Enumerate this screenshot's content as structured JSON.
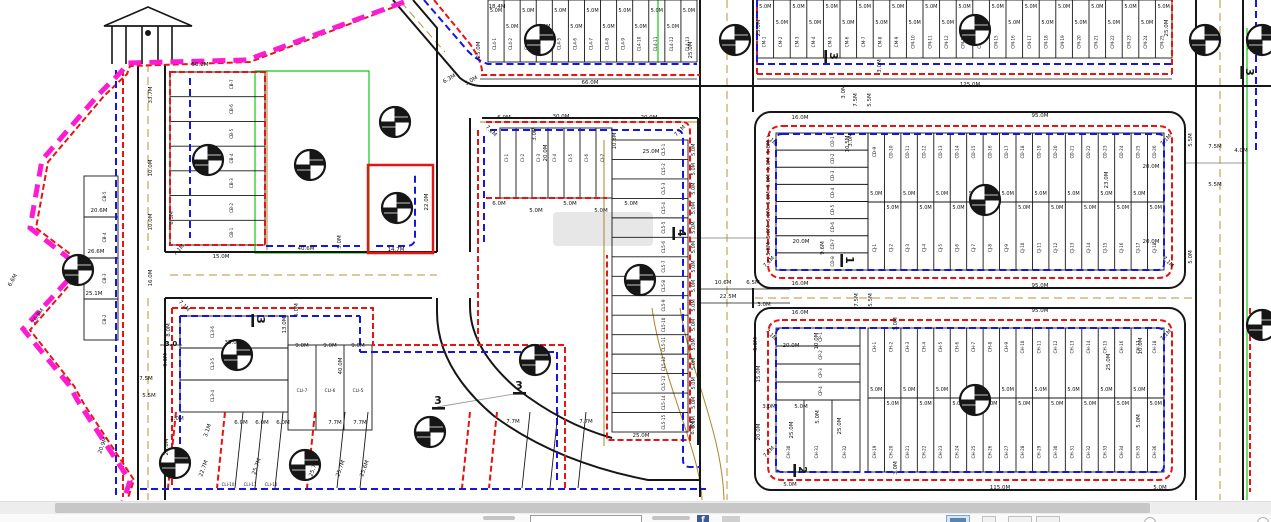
{
  "map": {
    "colors": {
      "red": "#e81313",
      "blue": "#1616e0",
      "magenta": "#ff1bd3",
      "green": "#14c814",
      "tan": "#a8862c",
      "tan_dash": "#b5913d",
      "black": "#161616",
      "gray": "#9a9a9a",
      "label": "#111111",
      "watermark": "rgba(120,120,120,0.18)"
    },
    "roads_black": [
      "M393,0 L460,78 Q470,86 482,86 H1271",
      "M413,0 L437,28 V252",
      "M437,298 V312 Q437,368 494,416 Q556,462 648,480 H700",
      "M470,118 V252",
      "M470,298 V306 Q470,348 516,388 Q562,424 612,438",
      "M482,118 H698",
      "M165,252 H437",
      "M165,298 H432",
      "M138,64 V500",
      "M165,64 V252",
      "M165,298 V500",
      "M700,0 V497",
      "M753,0 V112",
      "M753,288 V308",
      "M1196,0 V500",
      "M1243,0 V500",
      "M698,118 V445"
    ],
    "roads_thin": [
      "M480,79 H697",
      "M757,79 H1172",
      "M700,289 H790",
      "M700,303 H790",
      "M160,345 H182"
    ],
    "road_rects": [
      {
        "x": 755,
        "y": 112,
        "w": 430,
        "h": 176,
        "rx": 16
      },
      {
        "x": 755,
        "y": 308,
        "w": 430,
        "h": 182,
        "rx": 16
      }
    ],
    "gate": {
      "paths": [
        "M104,26 H192",
        "M104,26 L148,7 L192,26 Z",
        "M112,26 V64",
        "M126,26 V64",
        "M142,26 V64",
        "M158,26 V64",
        "M172,26 V64"
      ],
      "dot": [
        148,
        33,
        3
      ]
    },
    "tan_solid": [
      "M267,70 V250",
      "M604,140 V446",
      "M480,122 H698",
      "M652,308 C662,380 700,450 702,500",
      "M680,308 C690,372 722,432 724,500"
    ],
    "tan_dashed": [
      "M148,64 V250",
      "M148,298 V500",
      "M727,0 V500",
      "M1220,0 V500",
      "M170,275 H437",
      "M755,298 H1196",
      "M401,2 L445,52"
    ],
    "green_lines": [
      "M255,71 H369 V253 H255 Z",
      "M1247,28 V500",
      "M1247,50 L1262,28",
      "M658,0 V62"
    ],
    "gray_lines": [
      "M690,238 H770",
      "M1185,163 H1246",
      "M437,407 L520,393"
    ],
    "red_dashed": [
      "M402,4 L250,62 L130,66 L127,74 L104,96 L48,162 L36,228 L86,266 L30,330 L74,386 L84,404 L134,480 L128,498",
      "M123,70 V497",
      "M170,72 H265 V245 H170 Z",
      "M434,0 L470,44 Q480,58 482,70 V75 H700",
      "M757,74 V0 M757,74 H1172 M1172,74 V0",
      "M782,126 H1158 Q1172,126 1172,140 V264 Q1172,278 1158,278 H782 Q768,278 768,264 V140 Q768,126 782,126 Z",
      "M782,320 H1158 Q1172,320 1172,334 V466 Q1172,480 1158,480 H782 Q768,480 768,466 V334 Q768,320 782,320 Z",
      "M486,122 H682 Q690,122 690,132 V440 H607 V255",
      "M478,130 V340",
      "M486,198 H607",
      "M172,308 H373 V345 H565 V488",
      "M172,308 V488",
      "M176,412 L168,488 M225,412 L217,488 M315,412 L307,488 M470,412 L462,488 M497,412 L489,488",
      "M1250,308 V492"
    ],
    "red_solid": [
      "M368,165 H433 V253 H368 Z"
    ],
    "blue_dashed": [
      "M116,70 V495",
      "M190,78 V238",
      "M266,246 H360 M376,246 H406 Q415,246 415,238 V175",
      "M424,0 L467,50 Q476,60 488,64 H697",
      "M757,62 V0 M757,64 H1172",
      "M782,134 H1158 Q1164,134 1164,140 V264 Q1164,270 1158,270 H782 Q776,270 776,264 V140 Q776,134 782,134 Z",
      "M782,328 H1158 Q1164,328 1164,334 V466 Q1164,472 1158,472 H782 Q776,472 776,466 V334 Q776,328 782,328 Z",
      "M490,130 H676 Q683,130 683,138 V460 Q683,467 690,467 H700",
      "M484,136 V246",
      "M180,316 V480 M180,316 H360 M360,316 V352 M360,352 H557 M557,352 V480",
      "M140,489 H706",
      "M1256,0 V152"
    ],
    "magenta_path": "M404,2 L247,60 L128,63 L121,72 L99,94 L42,160 L30,228 L80,267 L23,329 L69,385 L79,403 L130,481 L123,502",
    "slant_black": [
      243,
      263,
      283,
      345,
      368,
      530,
      558,
      586
    ],
    "slant_top_y": 412,
    "slant_bot_y": 488,
    "slant_dx": -8,
    "lot_blocks": [
      {
        "id": "cl4",
        "type": "cols",
        "x": 488,
        "y": 0,
        "w": 209,
        "h": 62,
        "n": 13,
        "prefix": "CL4-",
        "start": 1,
        "step": 1,
        "label_y": 44,
        "dims": "5.0M",
        "dims_y": [
          12,
          28
        ]
      },
      {
        "id": "cm",
        "type": "cols",
        "x": 757,
        "y": 0,
        "w": 415,
        "h": 58,
        "n": 25,
        "prefix": "CM-",
        "start": 1,
        "step": 1,
        "label_y": 42,
        "dims": "5.0M",
        "dims_y": [
          8,
          24
        ]
      },
      {
        "id": "cb-a",
        "type": "rows",
        "x": 170,
        "y": 72,
        "w": 95,
        "h": 173,
        "n": 7,
        "prefix": "CB-",
        "start": 7,
        "step": -1,
        "label_x": 233
      },
      {
        "id": "cb-strip",
        "type": "rows",
        "x": 84,
        "y": 176,
        "w": 34,
        "h": 164,
        "n": 4,
        "prefix": "CB-",
        "start": 5,
        "step": -1,
        "label_x": 106
      },
      {
        "id": "cd-rows",
        "type": "rows",
        "x": 776,
        "y": 133,
        "w": 92,
        "h": 137,
        "n": 8,
        "prefix": "CD-",
        "start": 1,
        "step": 1,
        "label_x": 834
      },
      {
        "id": "e-cols",
        "type": "cols2",
        "x": 868,
        "y": 133,
        "w": 296,
        "h": 137,
        "n": 18,
        "split": 202,
        "prefixTop": "CD-",
        "startTop": 9,
        "prefixBot": "CJ-",
        "startBot": 1,
        "labelTopY": 152,
        "labelBotY": 248,
        "dims": "5.0M",
        "dims_y": [
          195,
          209
        ]
      },
      {
        "id": "cp-rows",
        "type": "rows",
        "x": 776,
        "y": 328,
        "w": 84,
        "h": 72,
        "n": 4,
        "prefix": "CP-",
        "start": 1,
        "step": 1,
        "label_x": 822
      },
      {
        "id": "ch-left",
        "type": "cols",
        "x": 776,
        "y": 400,
        "w": 84,
        "h": 72,
        "n": 3,
        "prefix": "CH-",
        "start": 30,
        "step": 1,
        "label_y": 452
      },
      {
        "id": "f-cols",
        "type": "cols2",
        "x": 868,
        "y": 328,
        "w": 296,
        "h": 144,
        "n": 18,
        "split": 398,
        "prefixTop": "CH-",
        "startTop": 1,
        "prefixBot": "CH-",
        "startBot": 19,
        "labelTopY": 347,
        "labelBotY": 452,
        "dims": "5.0M",
        "dims_y": [
          391,
          405
        ]
      },
      {
        "id": "ci-cols",
        "type": "cols",
        "x": 500,
        "y": 128,
        "w": 112,
        "h": 70,
        "n": 7,
        "prefix": "CI-",
        "start": 1,
        "step": 1,
        "label_y": 158
      },
      {
        "id": "cl5-strip",
        "type": "rows",
        "x": 612,
        "y": 140,
        "w": 76,
        "h": 292,
        "n": 15,
        "prefix": "CL5-",
        "start": 1,
        "step": 1,
        "label_x": 665,
        "side_dim": "5.0M",
        "side_x": 695
      },
      {
        "id": "cl3-rows",
        "type": "rows",
        "x": 180,
        "y": 316,
        "w": 108,
        "h": 96,
        "n": 3,
        "prefix": "CL3-",
        "start": 6,
        "step": -1,
        "label_x": 214
      },
      {
        "id": "cli-cols",
        "type": "cols",
        "x": 288,
        "y": 345,
        "w": 84,
        "h": 85,
        "n": 3,
        "prefix": "CLI-",
        "start": 7,
        "step": -1,
        "label_y": 392,
        "label_rot": 0
      }
    ],
    "markers": [
      [
        78,
        270
      ],
      [
        208,
        160
      ],
      [
        310,
        165
      ],
      [
        395,
        122
      ],
      [
        397,
        208
      ],
      [
        540,
        40
      ],
      [
        735,
        40
      ],
      [
        975,
        30
      ],
      [
        1205,
        40
      ],
      [
        1262,
        40
      ],
      [
        640,
        280
      ],
      [
        535,
        360
      ],
      [
        985,
        200
      ],
      [
        975,
        400
      ],
      [
        1262,
        325
      ],
      [
        175,
        463
      ],
      [
        305,
        465
      ],
      [
        430,
        432
      ],
      [
        237,
        355
      ]
    ],
    "section_markers": [
      [
        "3",
        830,
        56,
        90
      ],
      [
        "3",
        1246,
        72,
        90
      ],
      [
        "1",
        846,
        260,
        90
      ],
      [
        "4",
        678,
        233,
        90
      ],
      [
        "2",
        799,
        470,
        90
      ],
      [
        "3",
        438,
        404,
        0
      ],
      [
        "3",
        519,
        389,
        0
      ],
      [
        "3",
        257,
        320,
        90
      ]
    ],
    "dim_labels": [
      [
        "18.4M",
        497,
        8,
        0
      ],
      [
        "50.2M",
        200,
        66,
        0
      ],
      [
        "25.0M",
        480,
        50,
        -90
      ],
      [
        "25.0M",
        692,
        50,
        -90
      ],
      [
        "66.0M",
        590,
        84,
        0
      ],
      [
        "6.3M",
        450,
        80,
        -30
      ],
      [
        "3.0M",
        472,
        82,
        -30
      ],
      [
        "25.0M",
        760,
        28,
        -90
      ],
      [
        "25.0M",
        1168,
        28,
        -90
      ],
      [
        "125.0M",
        970,
        86,
        0
      ],
      [
        "7.5M",
        857,
        100,
        -90
      ],
      [
        "5.5M",
        871,
        100,
        -90
      ],
      [
        "3.0M",
        845,
        92,
        -90
      ],
      [
        "3.0M",
        881,
        66,
        -90
      ],
      [
        "3.0M",
        852,
        140,
        -90
      ],
      [
        "33.7M",
        152,
        95,
        -90
      ],
      [
        "10.0M",
        152,
        168,
        -90
      ],
      [
        "10.0M",
        152,
        222,
        -90
      ],
      [
        "16.0M",
        152,
        278,
        -90
      ],
      [
        "20.6M",
        99,
        212,
        0
      ],
      [
        "26.6M",
        96,
        253,
        0
      ],
      [
        "25.1M",
        94,
        295,
        0
      ],
      [
        "6.6M",
        14,
        281,
        -60
      ],
      [
        "26.9M",
        39,
        317,
        -55
      ],
      [
        "20.9M",
        104,
        446,
        -70
      ],
      [
        "3.0",
        171,
        346,
        0,
        7,
        1
      ],
      [
        "7.5M",
        146,
        380,
        0
      ],
      [
        "5.5M",
        149,
        397,
        0
      ],
      [
        "6.5M",
        173,
        218,
        -90
      ],
      [
        "7.1M",
        180,
        251,
        -45
      ],
      [
        "15.0M",
        221,
        258,
        0
      ],
      [
        "40.6M",
        306,
        250,
        0
      ],
      [
        "5.0M",
        341,
        242,
        -90
      ],
      [
        "14.7M",
        396,
        251,
        0
      ],
      [
        "22.0M",
        428,
        202,
        -90
      ],
      [
        "6.9M",
        504,
        119,
        0
      ],
      [
        "30.0M",
        561,
        118,
        0
      ],
      [
        "20.0M",
        649,
        119,
        0
      ],
      [
        "7.1M",
        490,
        132,
        45
      ],
      [
        "7.1M",
        681,
        132,
        -45
      ],
      [
        "3.0M",
        536,
        134,
        -90
      ],
      [
        "20.0M",
        547,
        153,
        -90
      ],
      [
        "10.8M",
        616,
        141,
        -90
      ],
      [
        "25.0M",
        651,
        153,
        0
      ],
      [
        "6.0M",
        499,
        205,
        0
      ],
      [
        "5.0M",
        536,
        212,
        0
      ],
      [
        "5.0M",
        570,
        205,
        0
      ],
      [
        "5.0M",
        601,
        212,
        0
      ],
      [
        "5.0M",
        631,
        205,
        0
      ],
      [
        "25.0M",
        641,
        437,
        0
      ],
      [
        "8.0M",
        694,
        428,
        -90
      ],
      [
        "10.6M",
        723,
        284,
        0
      ],
      [
        "6.5M",
        753,
        284,
        0
      ],
      [
        "22.5M",
        728,
        298,
        0
      ],
      [
        "3.0M",
        764,
        306,
        0
      ],
      [
        "7.5M",
        858,
        300,
        -90
      ],
      [
        "5.5M",
        872,
        300,
        -90
      ],
      [
        "16.0M",
        800,
        119,
        0
      ],
      [
        "95.0M",
        1040,
        117,
        0
      ],
      [
        "16.0M",
        800,
        285,
        0
      ],
      [
        "95.0M",
        1040,
        287,
        0
      ],
      [
        "7.1M",
        770,
        141,
        45
      ],
      [
        "7.1M",
        1167,
        141,
        -45
      ],
      [
        "7.1M",
        770,
        263,
        -45
      ],
      [
        "7.1M",
        1167,
        263,
        45
      ],
      [
        "5.8M",
        770,
        147,
        -90
      ],
      [
        "5.0M",
        770,
        164,
        -90
      ],
      [
        "5.0M",
        770,
        181,
        -90
      ],
      [
        "5.0M",
        770,
        198,
        -90
      ],
      [
        "5.0M",
        770,
        215,
        -90
      ],
      [
        "5.0M",
        770,
        232,
        -90
      ],
      [
        "5.8M",
        770,
        249,
        -90
      ],
      [
        "20.0M",
        801,
        243,
        0
      ],
      [
        "10.5M",
        849,
        144,
        -90
      ],
      [
        "9.6M",
        824,
        248,
        -90
      ],
      [
        "23.0M",
        1108,
        180,
        -90
      ],
      [
        "20.0M",
        1151,
        168,
        0
      ],
      [
        "20.0M",
        1151,
        243,
        0
      ],
      [
        "16.0M",
        800,
        314,
        0
      ],
      [
        "95.0M",
        1040,
        312,
        0
      ],
      [
        "115.0M",
        1000,
        489,
        0
      ],
      [
        "5.0M",
        790,
        486,
        0
      ],
      [
        "7.1M",
        770,
        336,
        45
      ],
      [
        "7.1M",
        1167,
        336,
        -45
      ],
      [
        "7.1M",
        770,
        453,
        -45
      ],
      [
        "20.0M",
        791,
        347,
        0
      ],
      [
        "10.0M",
        818,
        341,
        -90
      ],
      [
        "15.0M",
        760,
        374,
        -90
      ],
      [
        "5.0M",
        757,
        344,
        -90
      ],
      [
        "3.0M",
        769,
        408,
        0
      ],
      [
        "5.0M",
        801,
        408,
        0
      ],
      [
        "5.0M",
        819,
        417,
        -90
      ],
      [
        "20.0M",
        760,
        432,
        -90
      ],
      [
        "25.0M",
        793,
        430,
        -90
      ],
      [
        "25.0M",
        841,
        426,
        -90
      ],
      [
        "3.0M",
        897,
        324,
        -90
      ],
      [
        "3.0M",
        897,
        468,
        -90
      ],
      [
        "25.0M",
        1110,
        362,
        -90
      ],
      [
        "10.0M",
        1142,
        346,
        -90
      ],
      [
        "5.0M",
        1140,
        421,
        -90
      ],
      [
        "7.5M",
        1215,
        148,
        0
      ],
      [
        "4.0M",
        1241,
        152,
        0
      ],
      [
        "5.5M",
        1215,
        186,
        0
      ],
      [
        "5.5M",
        1192,
        140,
        -90
      ],
      [
        "5.0M",
        1192,
        257,
        -90
      ],
      [
        "7.1M",
        183,
        307,
        45
      ],
      [
        "8.0M",
        170,
        330,
        -90
      ],
      [
        "9.0M",
        167,
        360,
        -90
      ],
      [
        "35.0M",
        233,
        344,
        0
      ],
      [
        "13.0M",
        286,
        325,
        -90
      ],
      [
        "5.0M",
        298,
        310,
        -90
      ],
      [
        "9.0M",
        302,
        347,
        0
      ],
      [
        "9.0M",
        330,
        347,
        0
      ],
      [
        "9.0M",
        358,
        347,
        0
      ],
      [
        "40.0M",
        342,
        366,
        -90
      ],
      [
        "2.0M",
        177,
        420,
        0
      ],
      [
        "3.1M",
        209,
        431,
        -70
      ],
      [
        "6.0M",
        241,
        424,
        0
      ],
      [
        "6.0M",
        262,
        424,
        0
      ],
      [
        "6.0M",
        283,
        424,
        0
      ],
      [
        "7.7M",
        335,
        424,
        0
      ],
      [
        "7.7M",
        360,
        424,
        0
      ],
      [
        "7.7M",
        513,
        423,
        0
      ],
      [
        "7.7M",
        586,
        423,
        0
      ],
      [
        "22.7M",
        205,
        469,
        -70
      ],
      [
        "25.7M",
        258,
        467,
        -70
      ],
      [
        "25.7M",
        315,
        469,
        -70
      ],
      [
        "25.7M",
        342,
        469,
        -70
      ],
      [
        "25.6M",
        366,
        469,
        -70
      ],
      [
        "CLI-10",
        228,
        486,
        0,
        4
      ],
      [
        "CLI-11",
        250,
        486,
        0,
        4
      ],
      [
        "CLI-12",
        271,
        486,
        0,
        4
      ],
      [
        "20.6M",
        168,
        447,
        -90
      ],
      [
        "5.0M",
        1160,
        489,
        0
      ]
    ],
    "watermark": {
      "x": 553,
      "y": 212,
      "w": 100,
      "h": 34
    }
  },
  "footer": {
    "scrollbar": {
      "thumb_left": 55,
      "thumb_width": 1095
    },
    "input_value": "",
    "fb_glyph": "f",
    "colors": {
      "track": "#ededed",
      "thumb": "#c7c7c7",
      "fb": "#3a5a98",
      "active_icon": "#d6e6f6"
    }
  }
}
